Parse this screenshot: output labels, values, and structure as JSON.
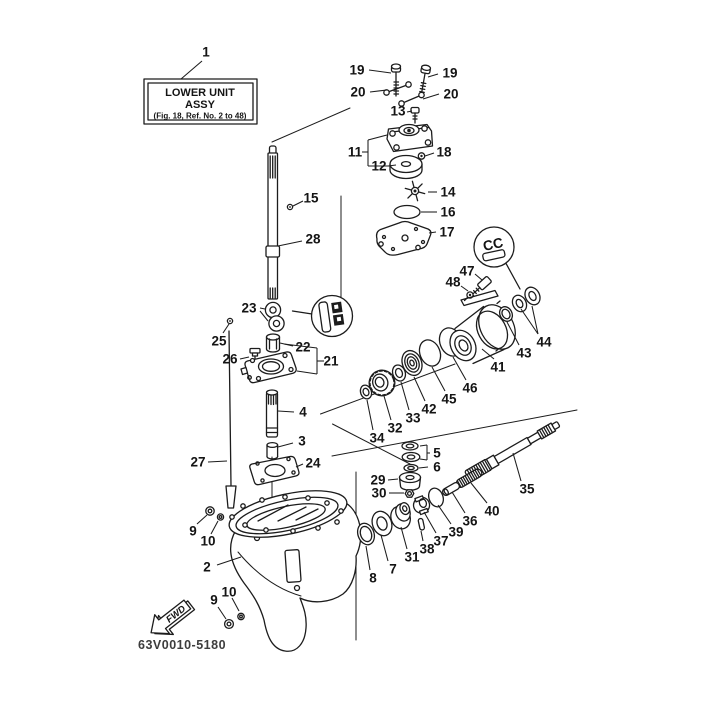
{
  "figure": {
    "title_box": {
      "line1": "LOWER UNIT",
      "line2": "ASSY",
      "line3": "(Fig. 18, Ref. No. 2 to 48)"
    },
    "detail_label": "CC",
    "fwd_label": "FWD",
    "drawing_code": "63V0010-5180",
    "ink_color": "#1c1c1c",
    "background_color": "#ffffff"
  },
  "callouts": [
    {
      "n": "1",
      "x": 206,
      "y": 52,
      "leaders": [
        [
          202,
          61,
          181,
          79
        ]
      ]
    },
    {
      "n": "19",
      "x": 357,
      "y": 70,
      "leaders": [
        [
          369,
          70,
          391,
          73
        ]
      ]
    },
    {
      "n": "19",
      "x": 450,
      "y": 73,
      "leaders": [
        [
          438,
          74,
          428,
          77
        ]
      ]
    },
    {
      "n": "20",
      "x": 358,
      "y": 92,
      "leaders": [
        [
          370,
          92,
          387,
          90
        ]
      ]
    },
    {
      "n": "20",
      "x": 451,
      "y": 94,
      "leaders": [
        [
          439,
          94,
          423,
          99
        ]
      ]
    },
    {
      "n": "13",
      "x": 398,
      "y": 111,
      "leaders": [
        [
          407,
          112,
          412,
          111
        ]
      ]
    },
    {
      "n": "11",
      "x": 355,
      "y": 152,
      "leaders": [
        [
          362,
          152,
          368,
          152
        ],
        [
          368,
          140,
          368,
          166
        ],
        [
          368,
          140,
          387,
          135
        ],
        [
          368,
          166,
          390,
          166
        ]
      ]
    },
    {
      "n": "12",
      "x": 379,
      "y": 166,
      "leaders": [
        [
          388,
          166,
          396,
          165
        ]
      ]
    },
    {
      "n": "18",
      "x": 444,
      "y": 152,
      "leaders": [
        [
          434,
          153,
          425,
          156
        ]
      ]
    },
    {
      "n": "14",
      "x": 448,
      "y": 192,
      "leaders": [
        [
          437,
          192,
          428,
          192
        ]
      ]
    },
    {
      "n": "16",
      "x": 448,
      "y": 212,
      "leaders": [
        [
          437,
          212,
          421,
          212
        ]
      ]
    },
    {
      "n": "17",
      "x": 447,
      "y": 232,
      "leaders": [
        [
          436,
          232,
          429,
          233
        ]
      ]
    },
    {
      "n": "15",
      "x": 311,
      "y": 198,
      "leaders": [
        [
          303,
          201,
          293,
          206
        ]
      ]
    },
    {
      "n": "28",
      "x": 313,
      "y": 239,
      "leaders": [
        [
          302,
          241,
          278,
          246
        ]
      ]
    },
    {
      "n": "23",
      "x": 249,
      "y": 308,
      "leaders": [
        [
          260,
          308,
          265,
          309
        ],
        [
          260,
          311,
          268,
          321
        ]
      ]
    },
    {
      "n": "25",
      "x": 219,
      "y": 341,
      "leaders": [
        [
          223,
          333,
          229,
          324
        ]
      ]
    },
    {
      "n": "26",
      "x": 230,
      "y": 359,
      "leaders": [
        [
          240,
          359,
          249,
          357
        ]
      ]
    },
    {
      "n": "22",
      "x": 303,
      "y": 347,
      "leaders": [
        [
          293,
          346,
          280,
          343
        ]
      ]
    },
    {
      "n": "21",
      "x": 331,
      "y": 361,
      "leaders": [
        [
          324,
          361,
          317,
          361
        ],
        [
          317,
          348,
          317,
          374
        ],
        [
          317,
          348,
          284,
          344
        ],
        [
          317,
          374,
          297,
          371
        ]
      ]
    },
    {
      "n": "4",
      "x": 303,
      "y": 412,
      "leaders": [
        [
          294,
          412,
          278,
          411
        ]
      ]
    },
    {
      "n": "3",
      "x": 302,
      "y": 441,
      "leaders": [
        [
          293,
          443,
          278,
          447
        ]
      ]
    },
    {
      "n": "24",
      "x": 313,
      "y": 463,
      "leaders": [
        [
          303,
          464,
          296,
          467
        ]
      ]
    },
    {
      "n": "27",
      "x": 198,
      "y": 462,
      "leaders": [
        [
          208,
          462,
          227,
          461
        ]
      ]
    },
    {
      "n": "9",
      "x": 193,
      "y": 531,
      "leaders": [
        [
          197,
          524,
          207,
          515
        ]
      ]
    },
    {
      "n": "10",
      "x": 208,
      "y": 541,
      "leaders": [
        [
          211,
          534,
          218,
          521
        ]
      ]
    },
    {
      "n": "2",
      "x": 207,
      "y": 567,
      "leaders": [
        [
          217,
          565,
          241,
          557
        ]
      ]
    },
    {
      "n": "9",
      "x": 214,
      "y": 600,
      "leaders": [
        [
          218,
          607,
          226,
          619
        ]
      ]
    },
    {
      "n": "10",
      "x": 229,
      "y": 592,
      "leaders": [
        [
          232,
          598,
          239,
          611
        ]
      ]
    },
    {
      "n": "34",
      "x": 377,
      "y": 438,
      "leaders": [
        [
          373,
          430,
          367,
          400
        ]
      ]
    },
    {
      "n": "32",
      "x": 395,
      "y": 428,
      "leaders": [
        [
          391,
          420,
          384,
          396
        ]
      ]
    },
    {
      "n": "33",
      "x": 413,
      "y": 418,
      "leaders": [
        [
          409,
          410,
          401,
          382
        ]
      ]
    },
    {
      "n": "42",
      "x": 429,
      "y": 409,
      "leaders": [
        [
          425,
          401,
          414,
          377
        ]
      ]
    },
    {
      "n": "45",
      "x": 449,
      "y": 399,
      "leaders": [
        [
          445,
          391,
          432,
          367
        ]
      ]
    },
    {
      "n": "46",
      "x": 470,
      "y": 388,
      "leaders": [
        [
          466,
          380,
          453,
          357
        ]
      ]
    },
    {
      "n": "41",
      "x": 498,
      "y": 367,
      "leaders": [
        [
          494,
          359,
          482,
          349
        ]
      ]
    },
    {
      "n": "43",
      "x": 524,
      "y": 353,
      "leaders": [
        [
          519,
          345,
          507,
          322
        ]
      ]
    },
    {
      "n": "44",
      "x": 544,
      "y": 342,
      "leaders": [
        [
          538,
          334,
          532,
          306
        ],
        [
          538,
          334,
          521,
          309
        ]
      ]
    },
    {
      "n": "47",
      "x": 467,
      "y": 271,
      "leaders": [
        [
          475,
          274,
          482,
          280
        ]
      ]
    },
    {
      "n": "48",
      "x": 453,
      "y": 282,
      "leaders": [
        [
          461,
          286,
          468,
          291
        ]
      ]
    },
    {
      "n": "5",
      "x": 437,
      "y": 453,
      "leaders": [
        [
          430,
          453,
          427,
          453
        ],
        [
          427,
          445,
          427,
          460
        ],
        [
          427,
          445,
          420,
          446
        ],
        [
          427,
          460,
          420,
          459
        ]
      ]
    },
    {
      "n": "6",
      "x": 437,
      "y": 467,
      "leaders": [
        [
          428,
          467,
          419,
          468
        ]
      ]
    },
    {
      "n": "29",
      "x": 378,
      "y": 480,
      "leaders": [
        [
          388,
          480,
          398,
          479
        ]
      ]
    },
    {
      "n": "30",
      "x": 379,
      "y": 493,
      "leaders": [
        [
          389,
          493,
          404,
          493
        ]
      ]
    },
    {
      "n": "36",
      "x": 470,
      "y": 521,
      "leaders": [
        [
          465,
          513,
          452,
          492
        ]
      ]
    },
    {
      "n": "40",
      "x": 492,
      "y": 511,
      "leaders": [
        [
          487,
          503,
          471,
          483
        ]
      ]
    },
    {
      "n": "39",
      "x": 456,
      "y": 532,
      "leaders": [
        [
          451,
          524,
          438,
          505
        ]
      ]
    },
    {
      "n": "37",
      "x": 441,
      "y": 541,
      "leaders": [
        [
          436,
          533,
          424,
          512
        ]
      ]
    },
    {
      "n": "38",
      "x": 427,
      "y": 549,
      "leaders": [
        [
          423,
          541,
          421,
          531
        ]
      ]
    },
    {
      "n": "31",
      "x": 412,
      "y": 557,
      "leaders": [
        [
          407,
          549,
          401,
          527
        ]
      ]
    },
    {
      "n": "7",
      "x": 393,
      "y": 569,
      "leaders": [
        [
          388,
          561,
          381,
          535
        ]
      ]
    },
    {
      "n": "8",
      "x": 373,
      "y": 578,
      "leaders": [
        [
          370,
          570,
          366,
          546
        ]
      ]
    },
    {
      "n": "35",
      "x": 527,
      "y": 489,
      "leaders": [
        [
          521,
          481,
          513,
          453
        ]
      ]
    }
  ]
}
